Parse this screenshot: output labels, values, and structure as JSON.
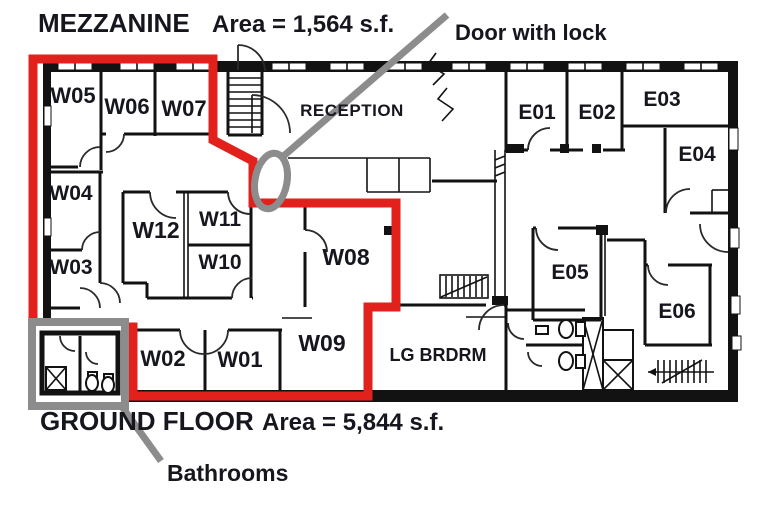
{
  "document": {
    "mezzanine_title": "MEZZANINE",
    "mezzanine_area": "Area = 1,564 s.f.",
    "ground_floor_title": "GROUND FLOOR",
    "ground_floor_area": "Area = 5,844 s.f."
  },
  "annotations": {
    "door_with_lock": "Door with lock",
    "bathrooms": "Bathrooms"
  },
  "rooms": {
    "w01": "W01",
    "w02": "W02",
    "w03": "W03",
    "w04": "W04",
    "w05": "W05",
    "w06": "W06",
    "w07": "W07",
    "w08": "W08",
    "w09": "W09",
    "w10": "W10",
    "w11": "W11",
    "w12": "W12",
    "e01": "E01",
    "e02": "E02",
    "e03": "E03",
    "e04": "E04",
    "e05": "E05",
    "e06": "E06",
    "reception": "RECEPTION",
    "lg_brdrm": "LG BRDRM"
  },
  "colors": {
    "highlight_red": "#e2211c",
    "annotation_gray": "#8c8c8c",
    "wall_black": "#121212",
    "label_color": "#16161e"
  }
}
